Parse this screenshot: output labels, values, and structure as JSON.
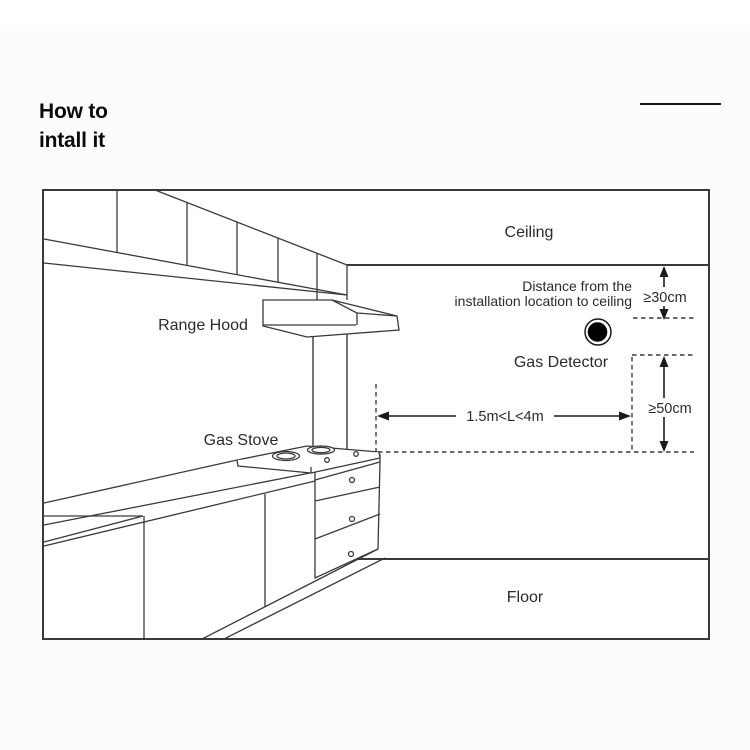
{
  "page": {
    "title_line1": "How to",
    "title_line2": "intall it"
  },
  "diagram": {
    "labels": {
      "ceiling": "Ceiling",
      "floor": "Floor",
      "range_hood": "Range Hood",
      "gas_stove": "Gas Stove",
      "gas_detector": "Gas Detector",
      "distance_note_line1": "Distance from the",
      "distance_note_line2": "installation location to ceiling"
    },
    "measurements": {
      "ceiling_clearance": "≥30cm",
      "stove_clearance": "≥50cm",
      "horizontal_range": "1.5m<L<4m"
    },
    "colors": {
      "line": "#3a3a3a",
      "text": "#2b2b2b",
      "detector_fill": "#000000",
      "background": "#ffffff"
    }
  }
}
